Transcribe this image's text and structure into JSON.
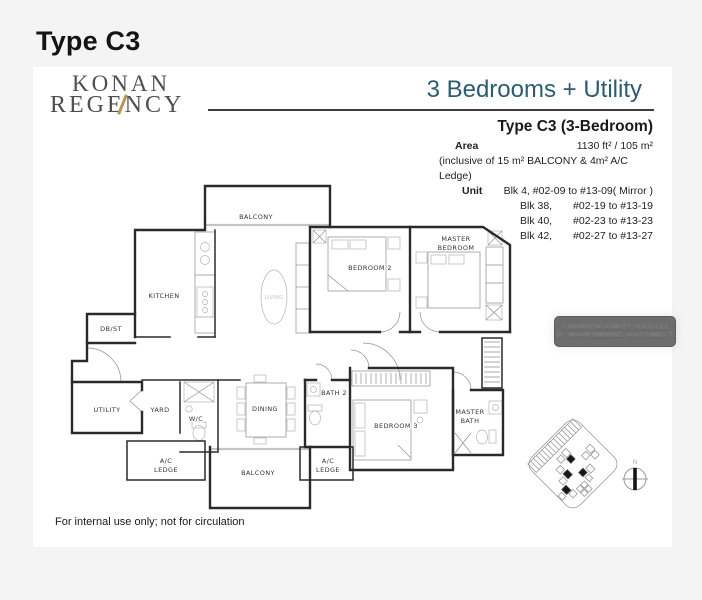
{
  "page": {
    "title": "Type C3",
    "footer": "For internal use only; not for circulation"
  },
  "logo": {
    "line1": "KONAN",
    "line2": "REGENCY",
    "accent_color": "#b5974f"
  },
  "header": {
    "subtitle": "3 Bedrooms + Utility",
    "subtitle_color": "#2b5c72",
    "plan_title": "Type C3 (3-Bedroom)"
  },
  "details": {
    "area_label": "Area",
    "area_value": "1130 ft² / 105 m²",
    "area_note": "(inclusive of 15 m² BALCONY & 4m² A/C Ledge)",
    "unit_label": "Unit",
    "unit_first": "Blk 4, #02-09 to #13-09( Mirror )",
    "units": [
      {
        "blk": "Blk 38,",
        "range": "#02-19 to #13-19"
      },
      {
        "blk": "Blk 40,",
        "range": "#02-23 to #13-23"
      },
      {
        "blk": "Blk 42,",
        "range": "#02-27 to #13-27"
      }
    ]
  },
  "watermark": {
    "line1": "S MAMNTNGA-MATS SOO1 CL1",
    "line2": "B - MAAM NMNBNG IAAO NMBO T"
  },
  "floorplan": {
    "labels": {
      "balcony_top": "BALCONY",
      "kitchen": "KITCHEN",
      "dbst": "DB/ST",
      "living": "LIVING",
      "bedroom2": "BEDROOM 2",
      "master1": "MASTER",
      "master2": "BEDROOM",
      "utility": "UTILITY",
      "yard": "YARD",
      "wc": "W/C",
      "dining": "DINING",
      "bath2": "BATH 2",
      "bedroom3": "BEDROOM 3",
      "mbath1": "MASTER",
      "mbath2": "BATH",
      "acl_left1": "A/C",
      "acl_left2": "LEDGE",
      "acl_mid1": "A/C",
      "acl_mid2": "LEDGE",
      "balcony_bottom": "BALCONY"
    }
  },
  "sitemap": {
    "north_label": "N"
  }
}
